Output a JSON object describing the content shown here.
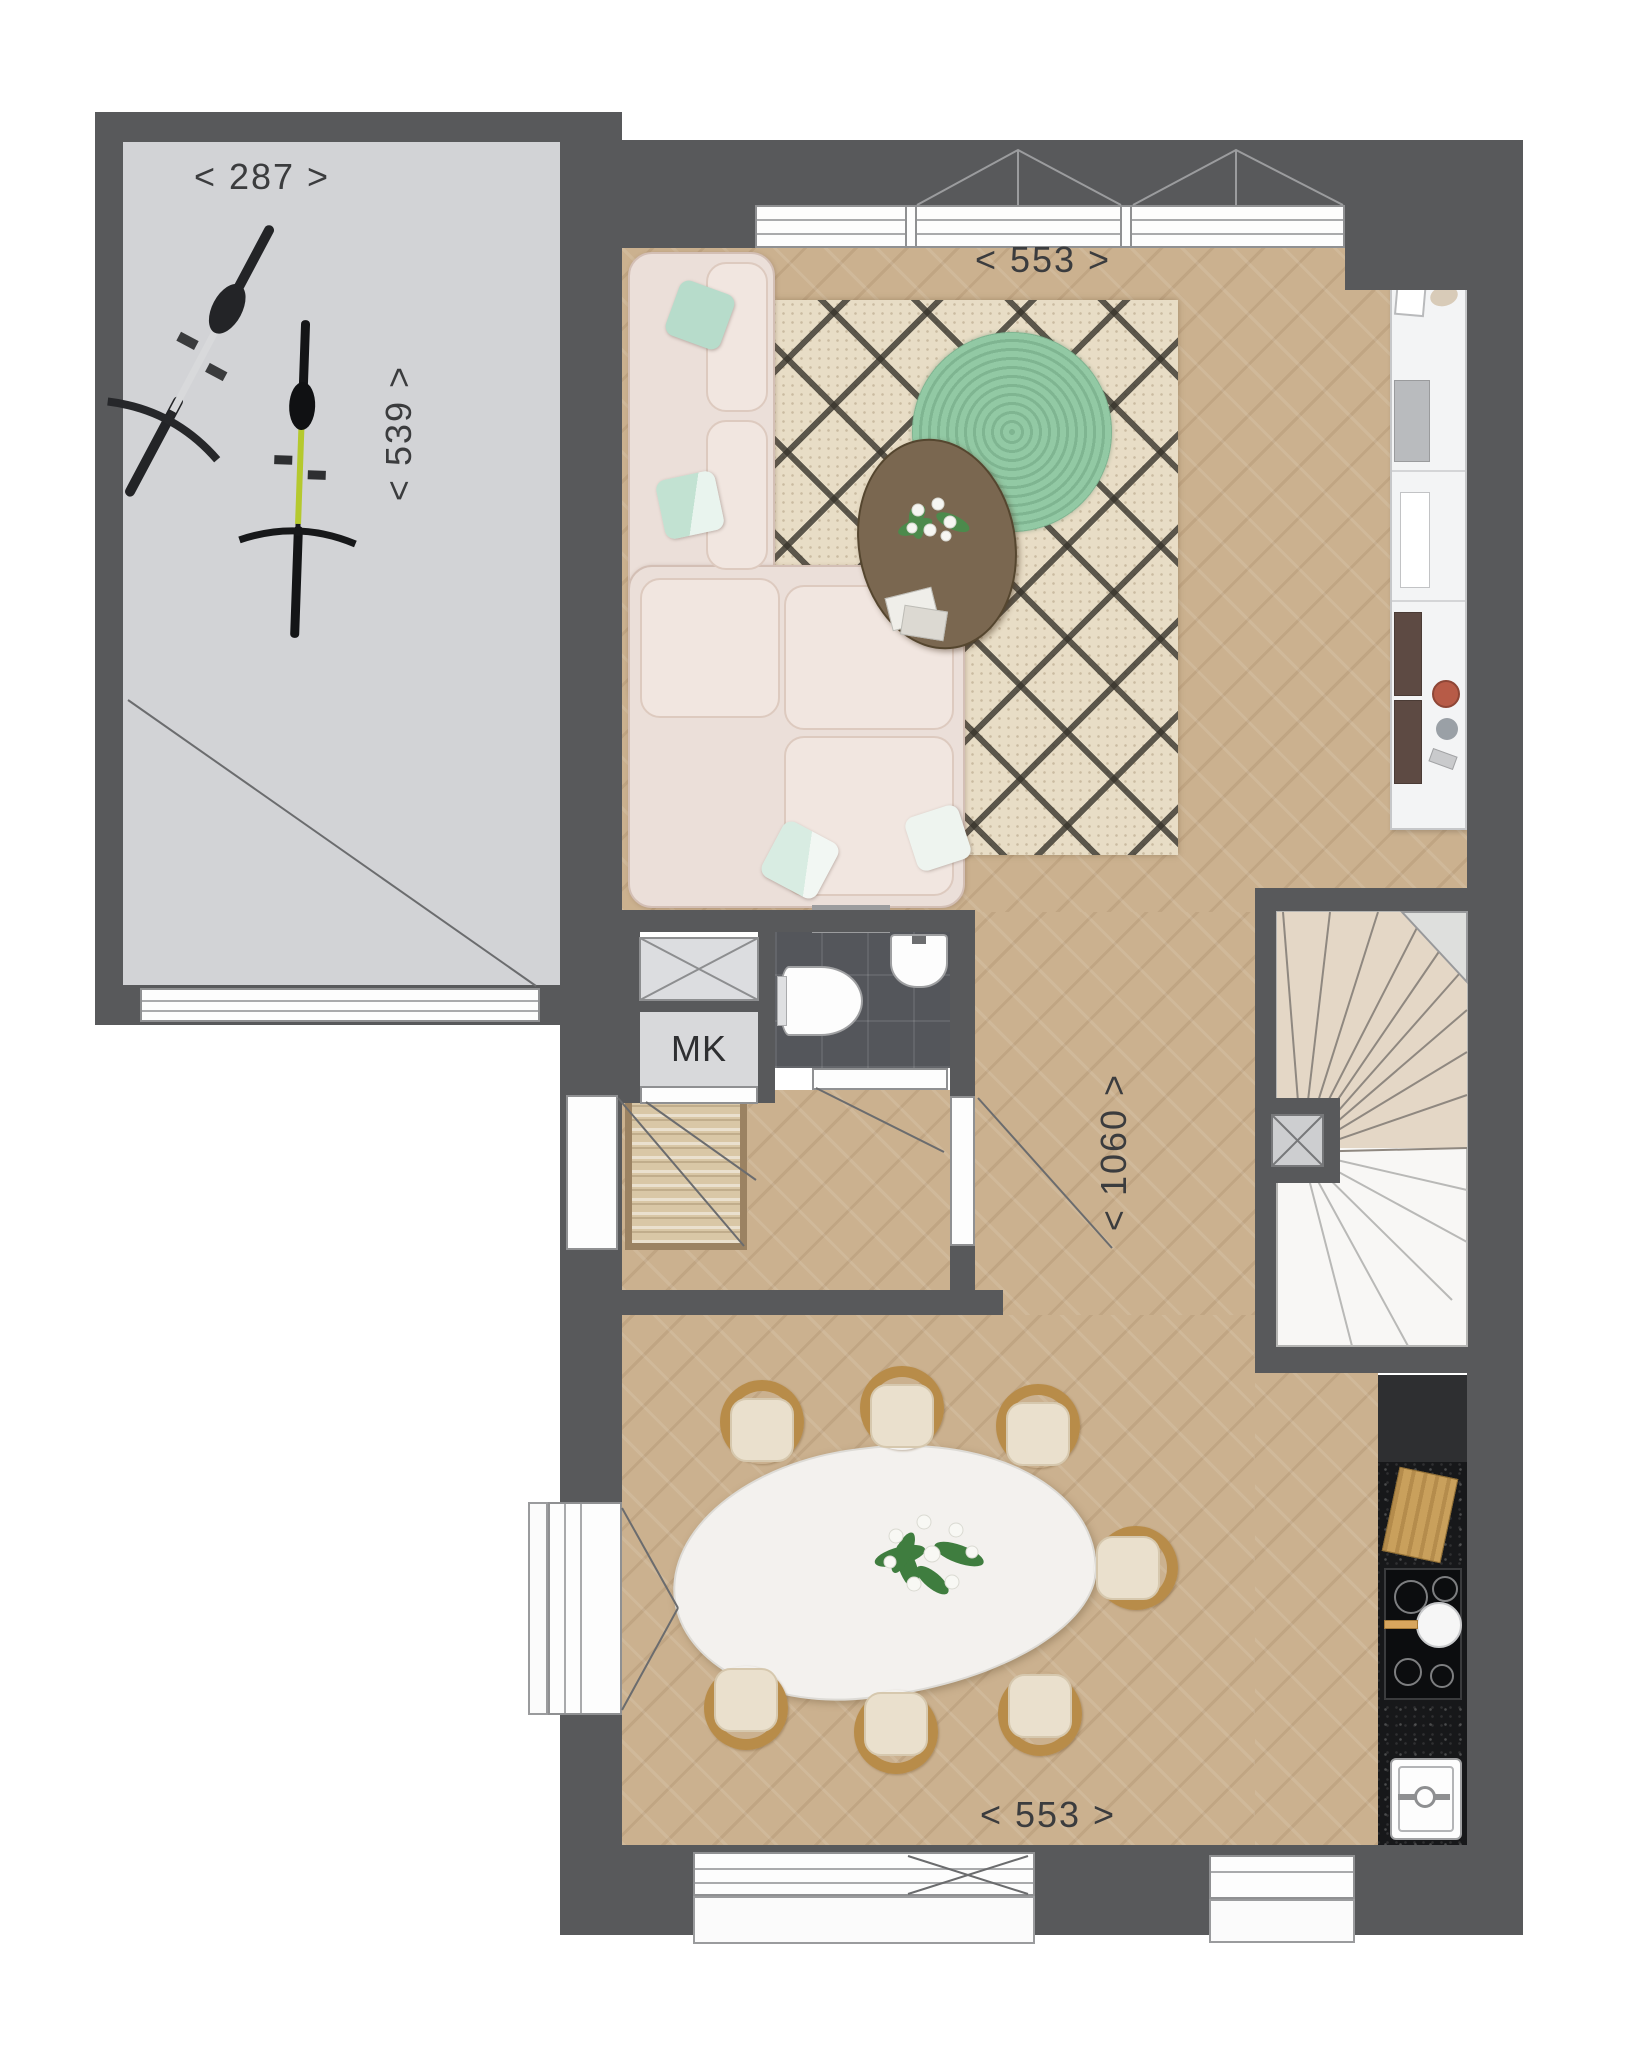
{
  "document": {
    "type": "architectural floor plan, ground floor with garage"
  },
  "labels": {
    "meter_cupboard": "MK"
  },
  "dimensions": {
    "garage_width": "< 287 >",
    "garage_depth": "< 539 >",
    "living_room_width": "< 553 >",
    "house_depth": "< 1060 >",
    "dining_room_width": "< 553 >"
  },
  "colors": {
    "wall": "#58595b",
    "garage_floor": "#d2d3d6",
    "wood_floor": "#cbb18f",
    "rug_base": "#e8ddc6",
    "rug_pattern": "#38342c",
    "round_rug": "#92c9a4",
    "sofa": "#ebdfd9",
    "mint_pillow": "#bfe0d1",
    "toilet_tiles": "#54565b",
    "kitchen_counter_dark": "#17181a",
    "kitchen_cabinet_white": "#f3f4f5",
    "stairs_wood": "#e4d7c6",
    "chair_wood": "#b88c49",
    "dimension_text": "#3b3c3e"
  },
  "icons": [
    "bicycle-icon",
    "shaft-cross-icon",
    "toilet-icon",
    "washbasin-icon",
    "stairs-icon",
    "cooktop-icon",
    "pan-icon",
    "sink-icon",
    "cutting-board-icon",
    "sofa-icon",
    "rug-icon",
    "round-rug-icon",
    "coffee-table-icon",
    "plant-icon",
    "dining-table-icon",
    "chair-icon",
    "doormat-icon",
    "door-swing-icon",
    "window-icon"
  ]
}
